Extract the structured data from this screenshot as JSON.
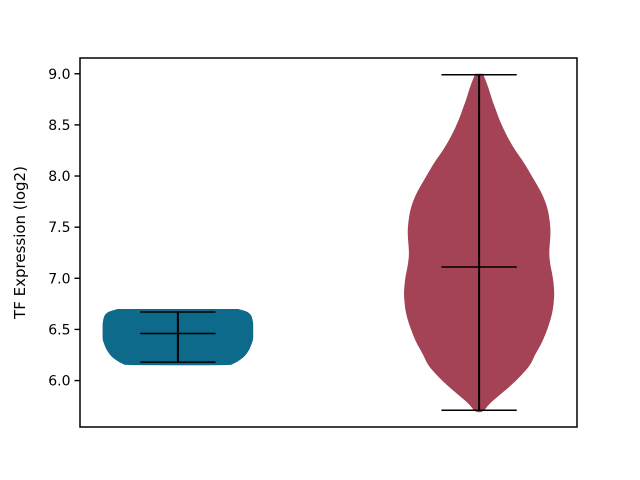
{
  "figure": {
    "background": "#ffffff",
    "width_px": 640,
    "height_px": 480
  },
  "chart_data": {
    "type": "violin",
    "title": "",
    "xlabel": "",
    "ylabel": "TF Expression (log2)",
    "ylim": [
      5.546,
      9.154
    ],
    "xlim": [
      0.675,
      2.325
    ],
    "yticks": [
      6.0,
      6.5,
      7.0,
      7.5,
      8.0,
      8.5,
      9.0
    ],
    "xticks": [],
    "grid": false,
    "legend": null,
    "violin_width": 0.5,
    "stat_line_color": "#000000",
    "series": [
      {
        "name": "violin-1",
        "position": 1,
        "color": "#0e6a8b",
        "min": 6.18,
        "max": 6.67,
        "mean": 6.46,
        "kde": [
          [
            6.7,
            0.8
          ],
          [
            6.68,
            0.9
          ],
          [
            6.66,
            0.95
          ],
          [
            6.63,
            0.98
          ],
          [
            6.6,
            0.99
          ],
          [
            6.56,
            1.0
          ],
          [
            6.52,
            1.0
          ],
          [
            6.48,
            1.0
          ],
          [
            6.44,
            1.0
          ],
          [
            6.4,
            1.0
          ],
          [
            6.36,
            0.98
          ],
          [
            6.32,
            0.96
          ],
          [
            6.28,
            0.93
          ],
          [
            6.24,
            0.89
          ],
          [
            6.21,
            0.84
          ],
          [
            6.18,
            0.78
          ],
          [
            6.16,
            0.72
          ],
          [
            6.15,
            0.7
          ]
        ]
      },
      {
        "name": "violin-2",
        "position": 2,
        "color": "#a34355",
        "min": 5.71,
        "max": 8.99,
        "mean": 7.11,
        "kde": [
          [
            9.0,
            0.05
          ],
          [
            8.93,
            0.09
          ],
          [
            8.85,
            0.13
          ],
          [
            8.75,
            0.17
          ],
          [
            8.65,
            0.22
          ],
          [
            8.55,
            0.27
          ],
          [
            8.45,
            0.33
          ],
          [
            8.35,
            0.4
          ],
          [
            8.25,
            0.48
          ],
          [
            8.15,
            0.58
          ],
          [
            8.05,
            0.66
          ],
          [
            7.95,
            0.74
          ],
          [
            7.85,
            0.82
          ],
          [
            7.75,
            0.88
          ],
          [
            7.65,
            0.92
          ],
          [
            7.55,
            0.94
          ],
          [
            7.45,
            0.95
          ],
          [
            7.35,
            0.94
          ],
          [
            7.25,
            0.93
          ],
          [
            7.15,
            0.94
          ],
          [
            7.05,
            0.97
          ],
          [
            6.95,
            0.99
          ],
          [
            6.85,
            1.0
          ],
          [
            6.75,
            0.99
          ],
          [
            6.65,
            0.97
          ],
          [
            6.55,
            0.93
          ],
          [
            6.45,
            0.88
          ],
          [
            6.35,
            0.82
          ],
          [
            6.25,
            0.74
          ],
          [
            6.15,
            0.68
          ],
          [
            6.05,
            0.56
          ],
          [
            5.95,
            0.42
          ],
          [
            5.85,
            0.26
          ],
          [
            5.77,
            0.13
          ],
          [
            5.69,
            0.05
          ]
        ]
      }
    ]
  }
}
